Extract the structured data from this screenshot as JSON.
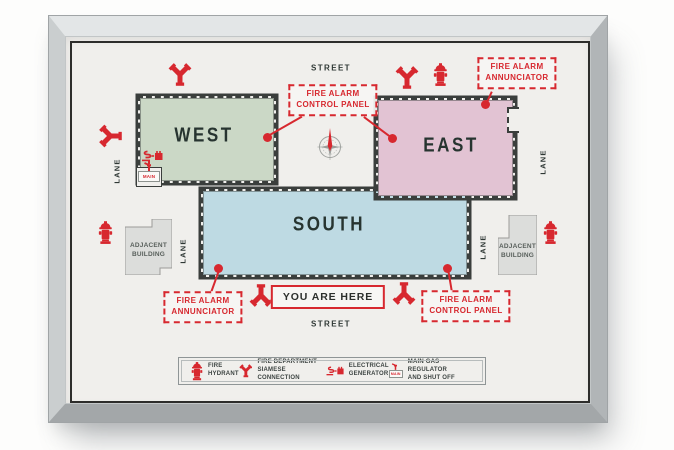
{
  "poster": {
    "buildings": {
      "west": "WEST",
      "east": "EAST",
      "south": "SOUTH"
    },
    "adjacent_building": {
      "line1": "ADJACENT",
      "line2": "BUILDING"
    },
    "streets": {
      "top": "STREET",
      "bottom": "STREET"
    },
    "lanes": {
      "west": "LANE",
      "south_left": "LANE",
      "east": "LANE",
      "south_right": "LANE"
    },
    "annotations": {
      "control_panel_top": {
        "line1": "FIRE ALARM",
        "line2": "CONTROL PANEL"
      },
      "annunciator_top_right": {
        "line1": "FIRE ALARM",
        "line2": "ANNUNCIATOR"
      },
      "annunciator_bottom_left": {
        "line1": "FIRE ALARM",
        "line2": "ANNUNCIATOR"
      },
      "control_panel_bottom_right": {
        "line1": "FIRE ALARM",
        "line2": "CONTROL PANEL"
      },
      "you_are_here": "YOU ARE HERE"
    },
    "gas_main_label": "MAIN",
    "legend": {
      "items": [
        {
          "icon": "fire-hydrant-icon",
          "line1": "FIRE",
          "line2": "HYDRANT"
        },
        {
          "icon": "siamese-connection-icon",
          "line1": "FIRE DEPARTMENT",
          "line2": "SIAMESE CONNECTION"
        },
        {
          "icon": "electrical-generator-icon",
          "line1": "ELECTRICAL",
          "line2": "GENERATOR"
        },
        {
          "icon": "gas-regulator-icon",
          "line1": "MAIN GAS REGULATOR",
          "line2": "AND SHUT OFF"
        }
      ]
    },
    "colors": {
      "accent_red": "#d7282f",
      "west_fill": "#cbd8c6",
      "east_fill": "#e2c3d3",
      "south_fill": "#bedae3",
      "adjacent_fill": "#dcdddb",
      "wall": "#3a3e3c",
      "text_dark": "#2e3734"
    }
  }
}
